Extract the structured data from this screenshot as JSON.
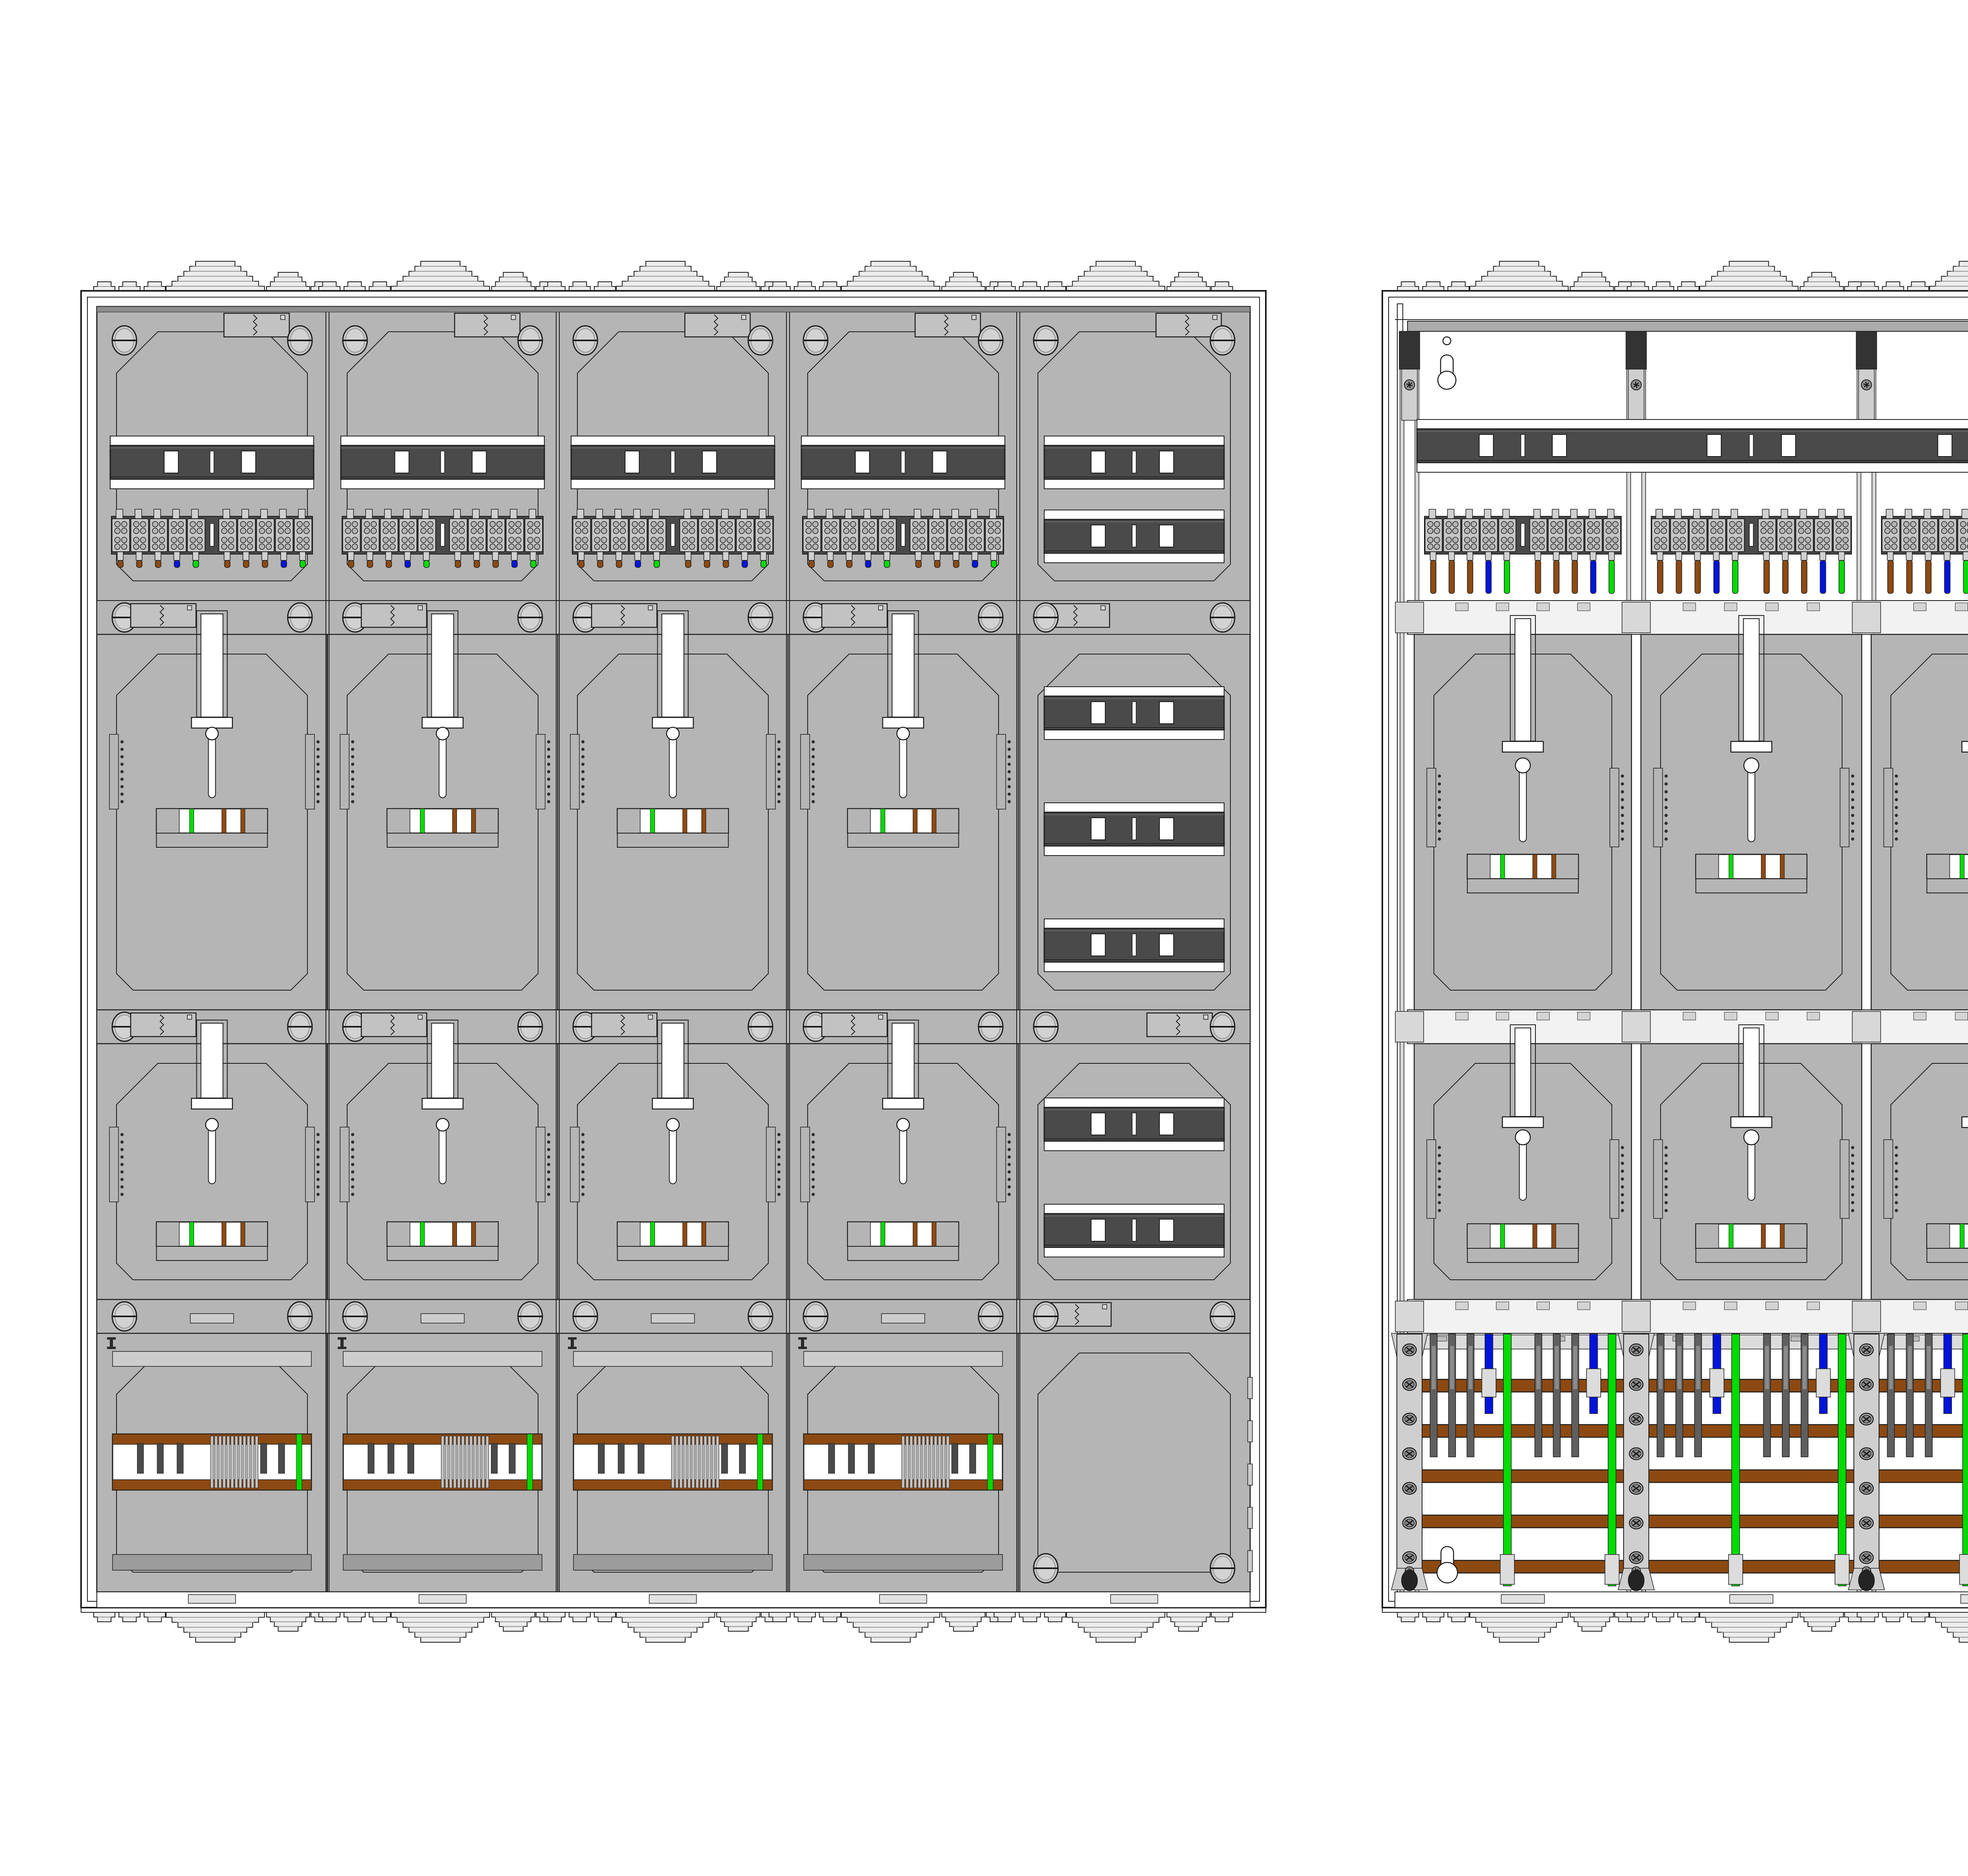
{
  "drawing": {
    "type": "technical-drawing",
    "subject": "Meter cabinet (Zaehlerschrank) assembly drawing - two panel views",
    "views": [
      {
        "id": "left",
        "label": "front view with cover panels"
      },
      {
        "id": "right",
        "label": "interior view with busbars and wiring"
      }
    ]
  },
  "colors": {
    "outline": "#1a1a1a",
    "white": "#ffffff",
    "panel": "#b5b5b5",
    "panel_light": "#cdcdcd",
    "panel_dark": "#9c9c9c",
    "shadow": "#8e8e8e",
    "rail": "#4a4a4a",
    "rail_dark": "#303030",
    "flange": "#ededed",
    "divider": "#f2f2f2",
    "block": "#c6c6c6",
    "block_circle": "#b4b4b4",
    "stub": "#d0d0d0",
    "support": "#d8d8d8",
    "support_plate": "#cfcfcf",
    "clip": "#dcdcdc",
    "screw": "#c6c6c6",
    "screw_dark": "#3d3d3d",
    "busbar_brown": "#8c4a12",
    "pe_green": "#00dc00",
    "pe_green_dark": "#00a000",
    "n_blue": "#0014dc",
    "n_blue_dark": "#000a96",
    "phase_gray": "#5f5f5f",
    "phase_light": "#8b8b8b",
    "perf_plate": "#cbcbcb",
    "tab_dark": "#4a4a4a",
    "oval_foot": "#242424"
  },
  "left_cabinet": {
    "view": "front-cover-view",
    "meter_columns": 4,
    "meter_rows": 2,
    "top_row": {
      "din_rail": true,
      "terminal_groups": 2,
      "terminals_per_group": 5,
      "wire_tip_colors": [
        "brown",
        "brown",
        "brown",
        "blue",
        "green"
      ]
    },
    "side_column_sections": [
      {
        "din_rails": 2
      },
      {
        "din_rails": 3
      },
      {
        "din_rails": 2
      },
      {
        "blank_cover": true
      }
    ],
    "bottom_row": {
      "busbar_color": "brown",
      "earth_stripe_color": "green",
      "tab_positions": [
        0.14,
        0.24,
        0.34,
        0.76,
        0.85
      ],
      "slat_count": 12
    }
  },
  "right_cabinet": {
    "view": "interior-view",
    "meter_bays": 4,
    "meter_rows": 2,
    "top_row": {
      "din_rail": true,
      "terminal_groups": 2,
      "terminals_per_group": 5,
      "wire_colors": [
        "brown",
        "brown",
        "brown",
        "blue",
        "green"
      ]
    },
    "distribution_bay": {
      "neutral_rail_color": "blue",
      "earth_rail_color": "green",
      "din_rail_sections": [
        2,
        3,
        2,
        1
      ],
      "perforated_plate": {
        "hole_rows": 9,
        "hole_cols": 13,
        "keyhole_cutout": true
      }
    },
    "busbar_zone": {
      "horizontal_busbars": 5,
      "busbar_color": "brown",
      "conductor_pattern": [
        "phase",
        "phase",
        "phase",
        "neutral",
        "earth"
      ],
      "groups_per_bay": 2,
      "keyhole_hanger": true
    }
  }
}
